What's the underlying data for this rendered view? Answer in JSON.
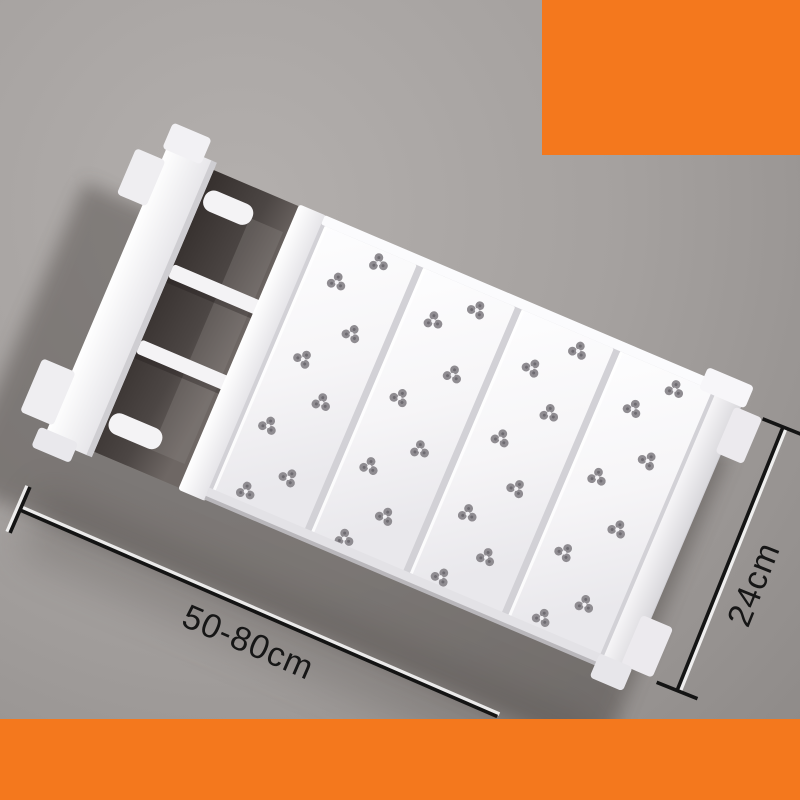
{
  "annotations": {
    "width_label": "50-80cm",
    "depth_label": "24cm"
  },
  "colors": {
    "background_gray": "#a6a2a0",
    "accent_orange": "#f4781d",
    "dimension_line_black": "#141414",
    "product_white": "#f7f6f8",
    "perforation_gray": "#8f8c91",
    "shadow_gray": "#3e3936"
  },
  "icons": {
    "perforation": "clover-trefoil-hole"
  }
}
